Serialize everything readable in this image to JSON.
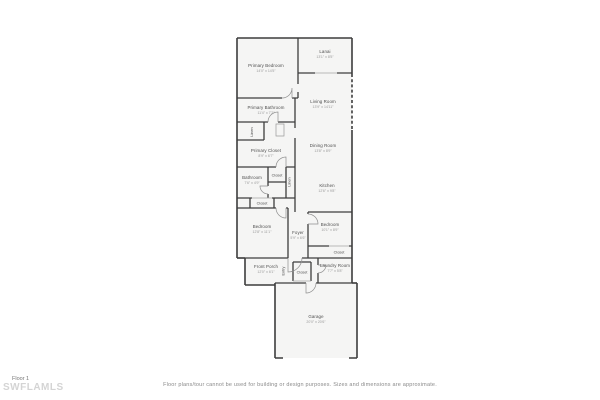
{
  "meta": {
    "floor_label": "Floor 1",
    "watermark": "SWFLAMLS",
    "disclaimer": "Floor plans/tour cannot be used for building or design purposes. Sizes and dimensions are approximate."
  },
  "palette": {
    "background": "#ffffff",
    "wall": "#3d3d3d",
    "floor_fill": "#f5f5f4",
    "label_text": "#4d4d4d",
    "dims_text": "#9a9a9a",
    "watermark_text": "#d4d4d4"
  },
  "rooms": {
    "primary_bedroom": {
      "name": "Primary Bedroom",
      "dims": "14'0\" x 14'5\""
    },
    "lanai": {
      "name": "Lanai",
      "dims": "13'1\" x 8'5\""
    },
    "living_room": {
      "name": "Living Room",
      "dims": "13'9\" x 14'11\""
    },
    "primary_bathroom": {
      "name": "Primary Bathroom",
      "dims": "11'4\" x 7'2\""
    },
    "linen1": {
      "name": "Linen"
    },
    "primary_closet": {
      "name": "Primary Closet",
      "dims": "8'9\" x 6'7\""
    },
    "dining_room": {
      "name": "Dining Room",
      "dims": "13'8\" x 8'9\""
    },
    "bathroom": {
      "name": "Bathroom",
      "dims": "7'6\" x 4'9\""
    },
    "closet_bath": {
      "name": "Closet"
    },
    "linen2": {
      "name": "Linen"
    },
    "kitchen": {
      "name": "Kitchen",
      "dims": "12'6\" x 9'8\""
    },
    "closet_hall": {
      "name": "Closet"
    },
    "bedroom_left": {
      "name": "Bedroom",
      "dims": "12'8\" x 11'1\""
    },
    "foyer": {
      "name": "Foyer",
      "dims": "5'9\" x 6'6\""
    },
    "bedroom_right": {
      "name": "Bedroom",
      "dims": "10'1\" x 8'9\""
    },
    "closet_bedroom2": {
      "name": "Closet"
    },
    "front_porch": {
      "name": "Front Porch",
      "dims": "12'0\" x 6'1\""
    },
    "entry": {
      "name": "Entry"
    },
    "closet_foyer": {
      "name": "Closet"
    },
    "laundry_room": {
      "name": "Laundry Room",
      "dims": "7'7\" x 5'8\""
    },
    "garage": {
      "name": "Garage",
      "dims": "20'0\" x 20'6\""
    }
  }
}
